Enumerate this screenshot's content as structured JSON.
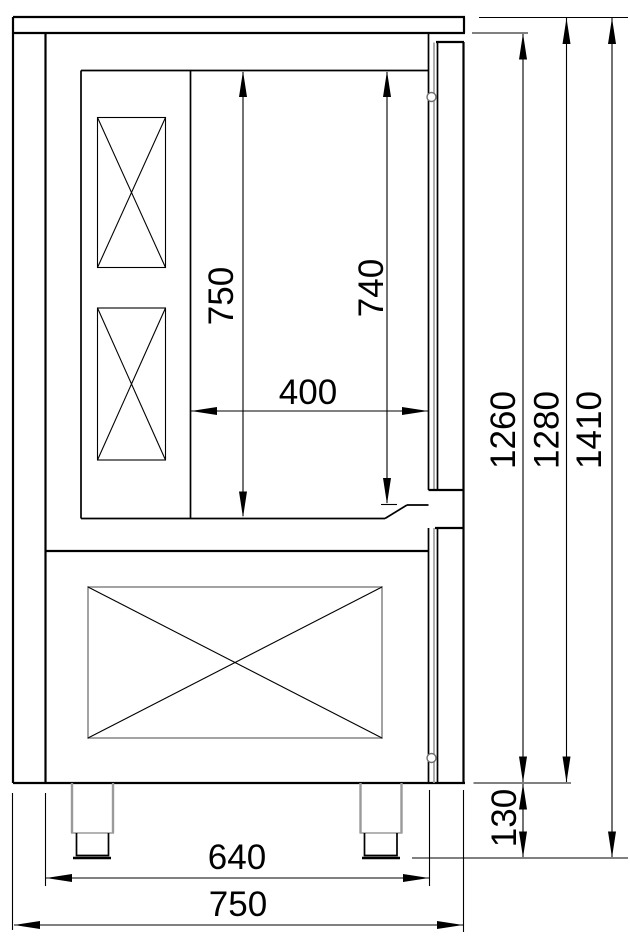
{
  "drawing": {
    "title": "cabinet-side-view-technical-drawing",
    "colors": {
      "line": "#000000",
      "secondary_line": "#9a9a9a",
      "background": "#ffffff"
    },
    "dimensions": {
      "interior_height_mm": "750",
      "door_opening_height_mm": "740",
      "interior_width_mm": "400",
      "inner_body_height_mm": "1260",
      "body_height_mm": "1280",
      "overall_height_mm": "1410",
      "foot_height_mm": "130",
      "inner_width_mm": "640",
      "overall_width_mm": "750"
    }
  }
}
